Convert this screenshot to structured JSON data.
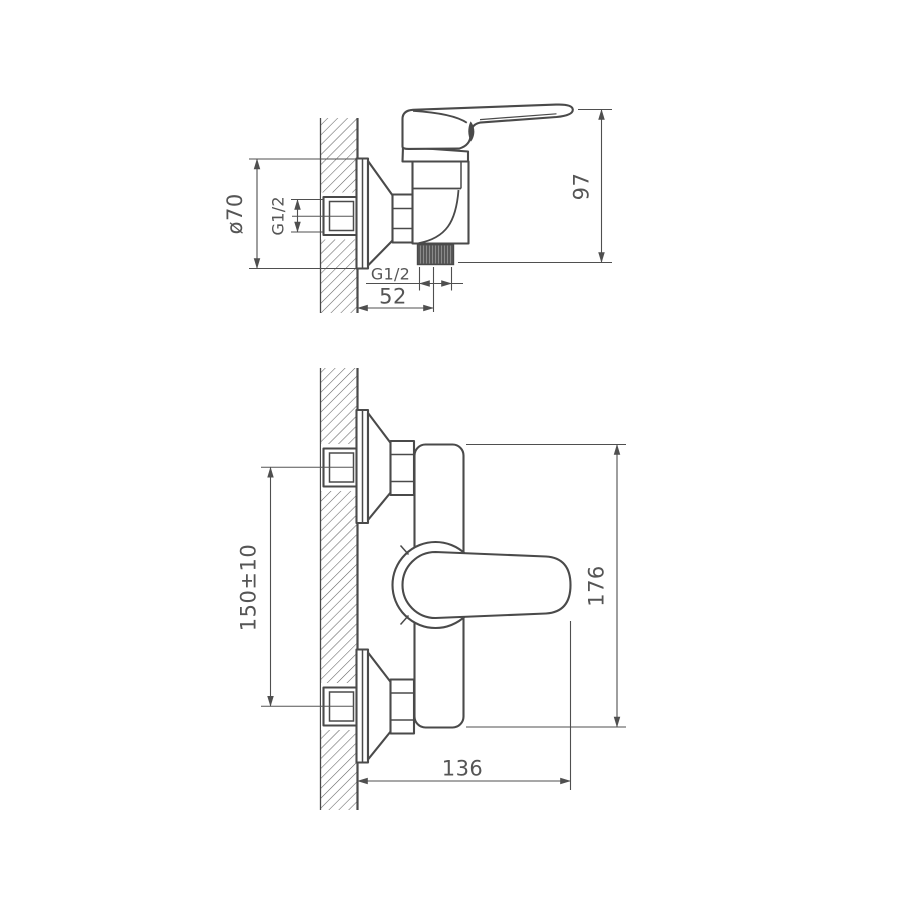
{
  "drawing": {
    "type": "technical-dimension-drawing",
    "subject": "wall-mounted single-lever shower mixer, two orthographic views",
    "colors": {
      "outline": "#4a4a4a",
      "dimension_line": "#4f4f4f",
      "text": "#555555",
      "background": "#ffffff",
      "thread_fill": "#575757"
    },
    "side_view": {
      "dims": {
        "escutcheon_diameter": "ø70",
        "wall_thread": "G1/2",
        "overall_height": "97",
        "outlet_thread": "G1/2",
        "wall_to_outlet": "52"
      }
    },
    "front_view": {
      "dims": {
        "inlet_centers": "150±10",
        "overall_length": "176",
        "wall_to_handle": "136"
      }
    }
  }
}
